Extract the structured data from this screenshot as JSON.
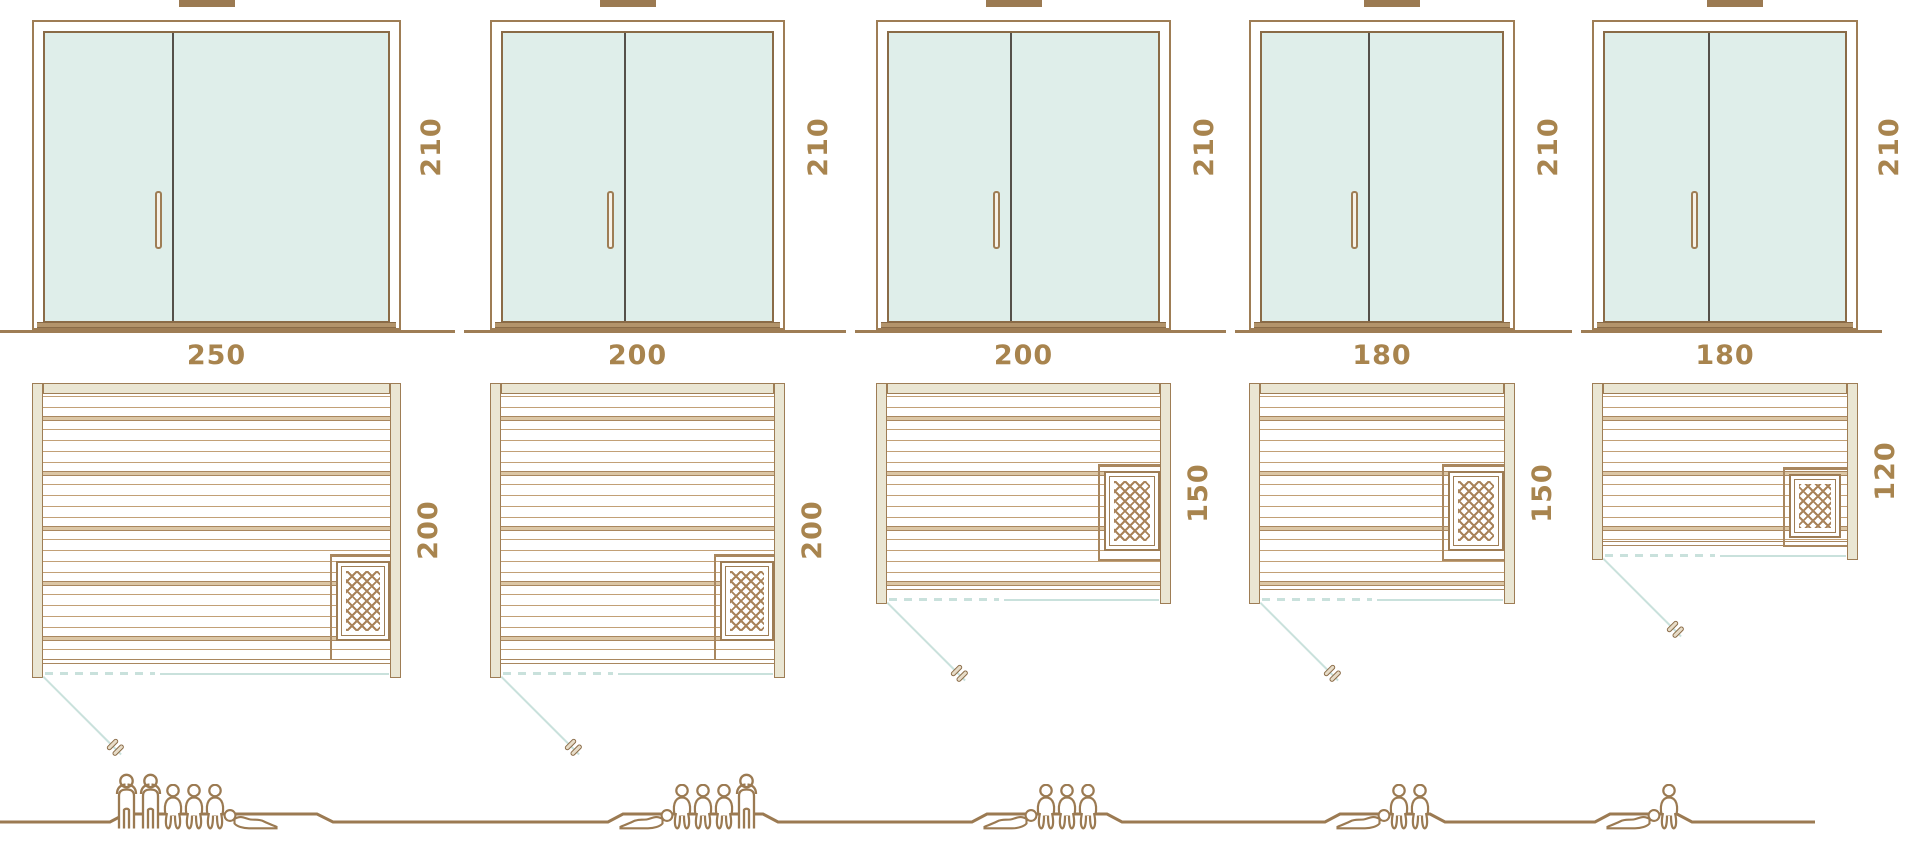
{
  "diagram_title": "Sauna size comparison diagram",
  "colors": {
    "outline_brown": "#9e7d55",
    "plank_brown": "#a9875f",
    "wall_beige": "#eae6d3",
    "glass_teal": "#dfeeea",
    "door_swing_teal": "#c9e1dc",
    "label_text": "#a8844e",
    "door_divider": "#55504a"
  },
  "columns": [
    {
      "door_height": "210",
      "plan_width": "250",
      "plan_depth": "200",
      "capacity": 6,
      "figures": [
        "standing",
        "standing",
        "seated",
        "seated",
        "seated",
        "reclining-right"
      ]
    },
    {
      "door_height": "210",
      "plan_width": "200",
      "plan_depth": "200",
      "capacity": 5,
      "figures": [
        "reclining-left",
        "seated",
        "seated",
        "seated",
        "standing"
      ]
    },
    {
      "door_height": "210",
      "plan_width": "200",
      "plan_depth": "150",
      "capacity": 4,
      "figures": [
        "reclining-left",
        "seated",
        "seated",
        "seated"
      ]
    },
    {
      "door_height": "210",
      "plan_width": "180",
      "plan_depth": "150",
      "capacity": 3,
      "figures": [
        "reclining-left",
        "seated",
        "seated"
      ]
    },
    {
      "door_height": "210",
      "plan_width": "180",
      "plan_depth": "120",
      "capacity": 2,
      "figures": [
        "reclining-left",
        "seated"
      ]
    }
  ]
}
